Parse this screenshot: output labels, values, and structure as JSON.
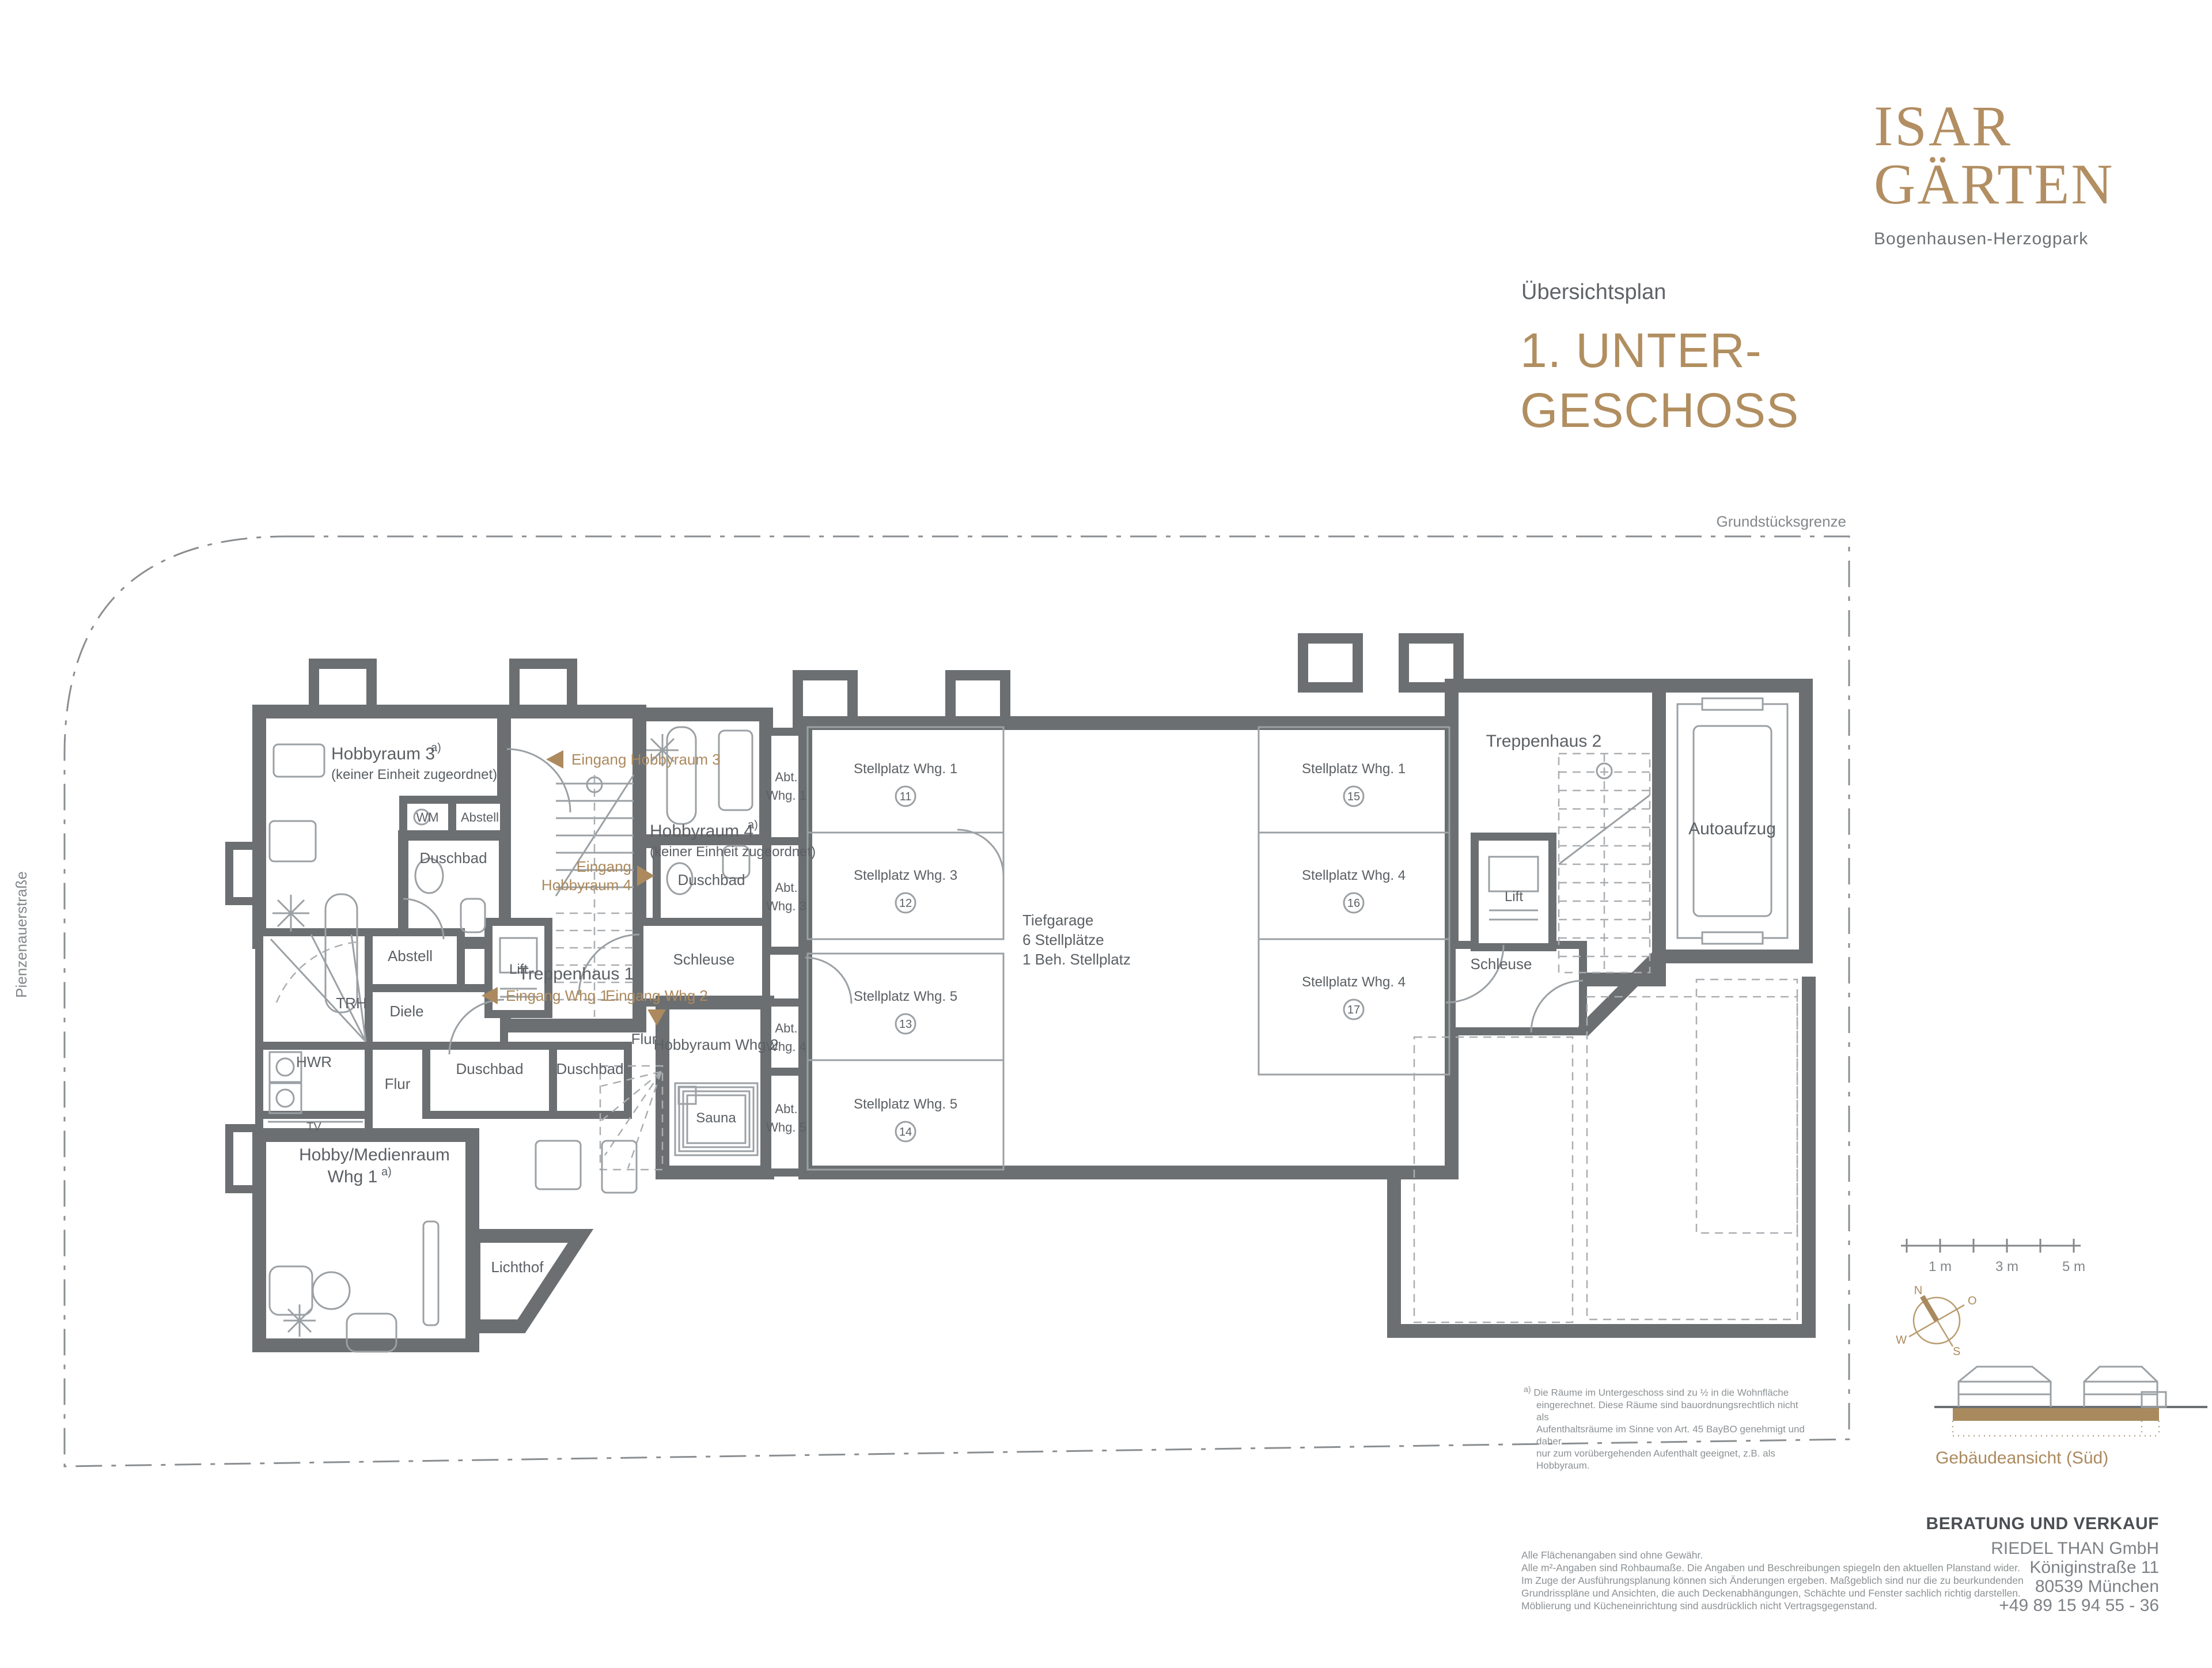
{
  "brand": {
    "name_line1": "ISAR",
    "name_line2": "GÄRTEN",
    "subtitle": "Bogenhausen-Herzogpark"
  },
  "header": {
    "eyebrow": "Übersichtsplan",
    "title_line1": "1. UNTER-",
    "title_line2": "GESCHOSS"
  },
  "plan": {
    "street": "Pienzenauerstraße",
    "boundary_label": "Grundstücksgrenze",
    "sup": "a)",
    "rooms": {
      "hobbyraum3": "Hobbyraum 3",
      "hobbyraum3_note": "(keiner Einheit zugeordnet)",
      "wm": "WM",
      "abstell_klein": "Abstell",
      "duschbad_hobby3": "Duschbad",
      "abstell": "Abstell",
      "trh": "TRH",
      "diele": "Diele",
      "hwr": "HWR",
      "tv": "TV",
      "flur_whg1": "Flur",
      "duschbad_whg1": "Duschbad",
      "duschbad_whg2": "Duschbad",
      "flur_whg2": "Flur",
      "hobby_medienraum_l1": "Hobby/Medienraum",
      "hobby_medienraum_l2": "Whg 1",
      "lichthof": "Lichthof",
      "hobbyraum4": "Hobbyraum 4",
      "hobbyraum4_note": "(keiner Einheit zugeordnet)",
      "duschbad_mitte": "Duschbad",
      "schleuse_links": "Schleuse",
      "hobbyraum_whg2": "Hobbyraum Whg 2",
      "sauna": "Sauna",
      "treppenhaus1": "Treppenhaus 1",
      "treppenhaus2": "Treppenhaus 2",
      "lift": "Lift",
      "lift2": "Lift",
      "schleuse_rechts": "Schleuse",
      "autoaufzug": "Autoaufzug"
    },
    "tiefgarage": {
      "l1": "Tiefgarage",
      "l2": "6 Stellplätze",
      "l3": "1 Beh. Stellplatz"
    },
    "abt": [
      {
        "l1": "Abt.",
        "l2": "Whg. 1"
      },
      {
        "l1": "Abt.",
        "l2": "Whg. 3"
      },
      {
        "l1": "Abt.",
        "l2": "Whg. 4"
      },
      {
        "l1": "Abt.",
        "l2": "Whg. 5"
      }
    ],
    "stalls": [
      {
        "label": "Stellplatz Whg. 1",
        "num": "11"
      },
      {
        "label": "Stellplatz Whg. 3",
        "num": "12"
      },
      {
        "label": "Stellplatz Whg. 5",
        "num": "13"
      },
      {
        "label": "Stellplatz Whg. 5",
        "num": "14"
      },
      {
        "label": "Stellplatz Whg. 1",
        "num": "15"
      },
      {
        "label": "Stellplatz Whg. 4",
        "num": "16"
      },
      {
        "label": "Stellplatz Whg. 4",
        "num": "17"
      }
    ],
    "entrances": {
      "hobbyraum3": "Eingang Hobbyraum 3",
      "hobbyraum4_l1": "Eingang",
      "hobbyraum4_l2": "Hobbyraum 4",
      "whg1": "Eingang Whg 1",
      "whg2": "Eingang Whg 2"
    }
  },
  "legend": {
    "scale": {
      "m1": "1 m",
      "m3": "3 m",
      "m5": "5 m"
    },
    "compass": {
      "n": "N",
      "o": "O",
      "s": "S",
      "w": "W"
    },
    "elevation_label": "Gebäudeansicht (Süd)"
  },
  "footnote": {
    "marker": "a)",
    "lines": [
      "Die Räume im Untergeschoss sind zu ½ in die Wohnfläche",
      "eingerechnet. Diese Räume sind bauordnungsrechtlich nicht als",
      "Aufenthaltsräume im Sinne von Art. 45 BayBO genehmigt und daher",
      "nur zum vorübergehenden Aufenthalt geeignet, z.B. als Hobbyraum."
    ]
  },
  "disclaimer": {
    "lines": [
      "Alle Flächenangaben sind ohne Gewähr.",
      "Alle m²-Angaben sind Rohbaumaße. Die Angaben und Beschreibungen spiegeln den aktuellen Planstand wider.",
      "Im Zuge der Ausführungsplanung können sich Änderungen ergeben. Maßgeblich sind nur die zu beurkundenden",
      "Grundrisspläne und Ansichten, die auch Deckenabhängungen, Schächte und Fenster sachlich richtig darstellen.",
      "Möblierung und Kücheneinrichtung sind ausdrücklich nicht Vertragsgegenstand."
    ]
  },
  "contact": {
    "heading": "BERATUNG UND VERKAUF",
    "lines": [
      "RIEDEL THAN GmbH",
      "Königinstraße 11",
      "80539 München",
      "+49 89 15 94 55 - 36"
    ]
  }
}
